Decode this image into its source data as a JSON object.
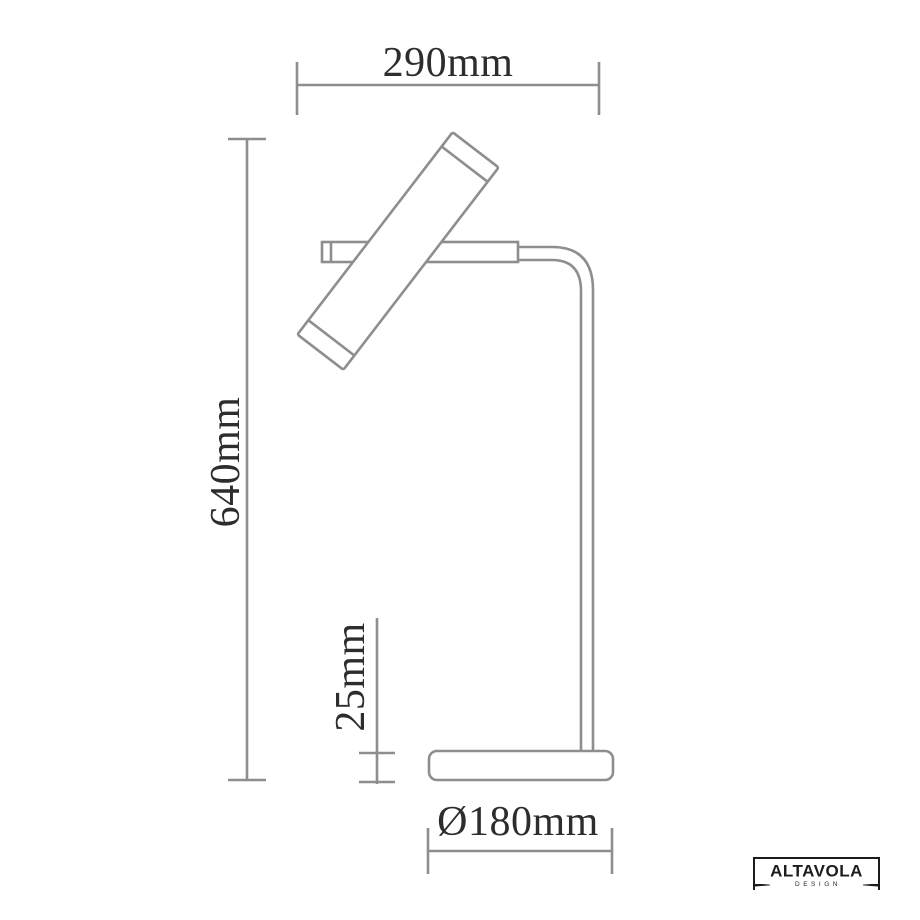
{
  "drawing": {
    "title": "table lamp dimension drawing",
    "dimensions": {
      "width": {
        "label": "290mm",
        "value_mm": 290
      },
      "height": {
        "label": "640mm",
        "value_mm": 640
      },
      "base_height": {
        "label": "25mm",
        "value_mm": 25
      },
      "base_diameter": {
        "label": "Ø180mm",
        "value_mm": 180
      }
    }
  },
  "logo": {
    "brand": "ALTAVOLA",
    "subtitle": "DESIGN"
  },
  "colors": {
    "line": "#8e8e8e",
    "text": "#2d2d2d",
    "logo": "#1c1c1c",
    "background": "#ffffff"
  }
}
